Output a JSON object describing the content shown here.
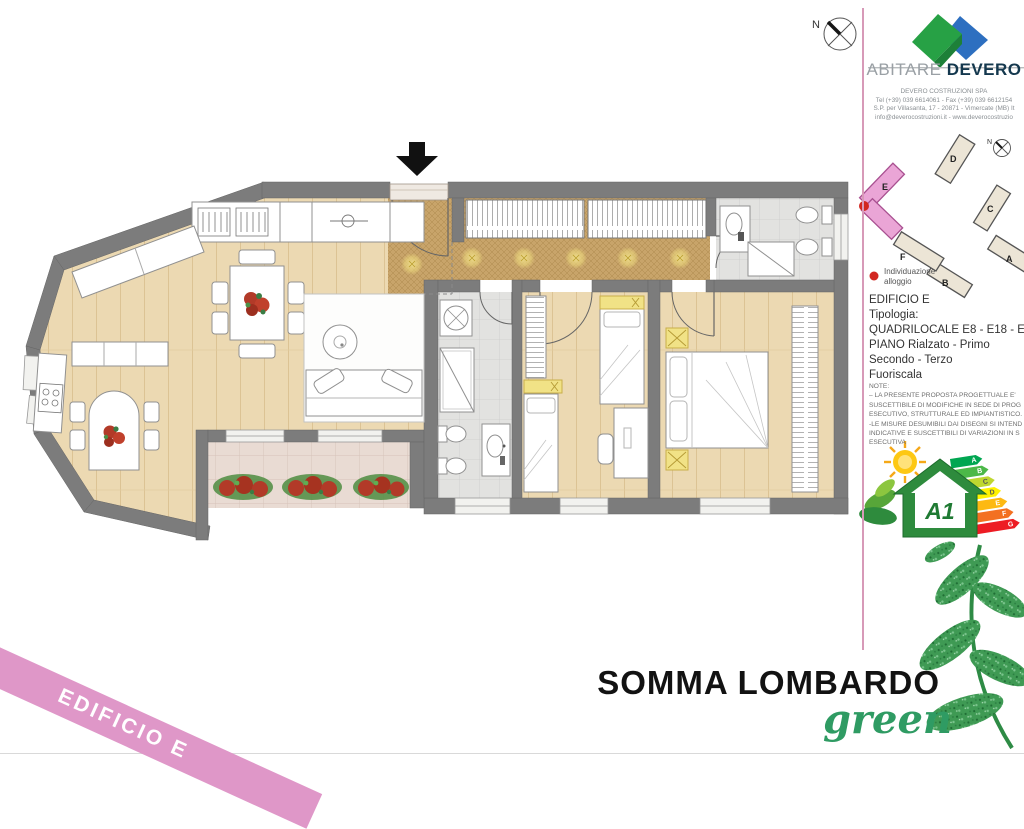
{
  "document": {
    "footer_title": "SOMMA LOMBARDO",
    "footer_subtitle": "green",
    "corner_ribbon": "EDIFICIO E",
    "plan_north_label": "N"
  },
  "sidebar": {
    "brand": {
      "word1": "ABITARE",
      "word2": "DEVERO"
    },
    "company_lines": [
      "DEVERO COSTRUZIONI SPA",
      "Tel (+39) 039 6614061 - Fax (+39) 039 6612154",
      "S.P. per Villasanta, 17 - 20871 - Vimercate (MB) It",
      "info@deverocostruzioni.it - www.deverocostruzio"
    ],
    "sitemap": {
      "north_label": "N",
      "buildings": [
        "A",
        "B",
        "C",
        "D",
        "E",
        "F"
      ],
      "highlighted_building": "E",
      "legend_line1": "Individuazione",
      "legend_line2": "alloggio"
    },
    "unit_info": {
      "line1": "EDIFICIO E",
      "line2": "Tipologia:",
      "line3": "QUADRILOCALE E8 - E18 - E30 -",
      "line4": "PIANO Rialzato - Primo",
      "line5": "Secondo - Terzo",
      "line6": "Fuoriscala"
    },
    "notes_lines": [
      "NOTE:",
      "– LA PRESENTE PROPOSTA PROGETTUALE E'",
      "SUSCETTIBILE DI MODIFICHE IN SEDE DI PROG",
      "ESECUTIVO, STRUTTURALE ED IMPIANTISTICO.",
      "-LE MISURE DESUMIBILI DAI DISEGNI SI INTEND",
      "INDICATIVE E SUSCETTIBILI DI VARIAZIONI IN S",
      "ESECUTIVA"
    ],
    "energy": {
      "class_label": "A1",
      "scale": [
        "A",
        "B",
        "C",
        "D",
        "E",
        "F",
        "G"
      ],
      "scale_colors": [
        "#00a651",
        "#4cb848",
        "#bfd730",
        "#fff200",
        "#fdb913",
        "#f37021",
        "#ed1c24"
      ]
    }
  },
  "colors": {
    "wall": "#7c7c7c",
    "wood_floor": "#ecd9b2",
    "corridor_floor": "#c7a368",
    "bath_tile": "#e2e2e0",
    "balcony_tile": "#e9dbd3",
    "ribbon_pink": "#df97c8",
    "divider_pink": "#d79ab8",
    "brand_green": "#27a145",
    "brand_blue": "#2d6fc0",
    "title_green": "#2f9b63",
    "highlight_building_pink": "#eaa5d6",
    "marker_red": "#d22721",
    "accent_yellow": "#f1e286"
  }
}
